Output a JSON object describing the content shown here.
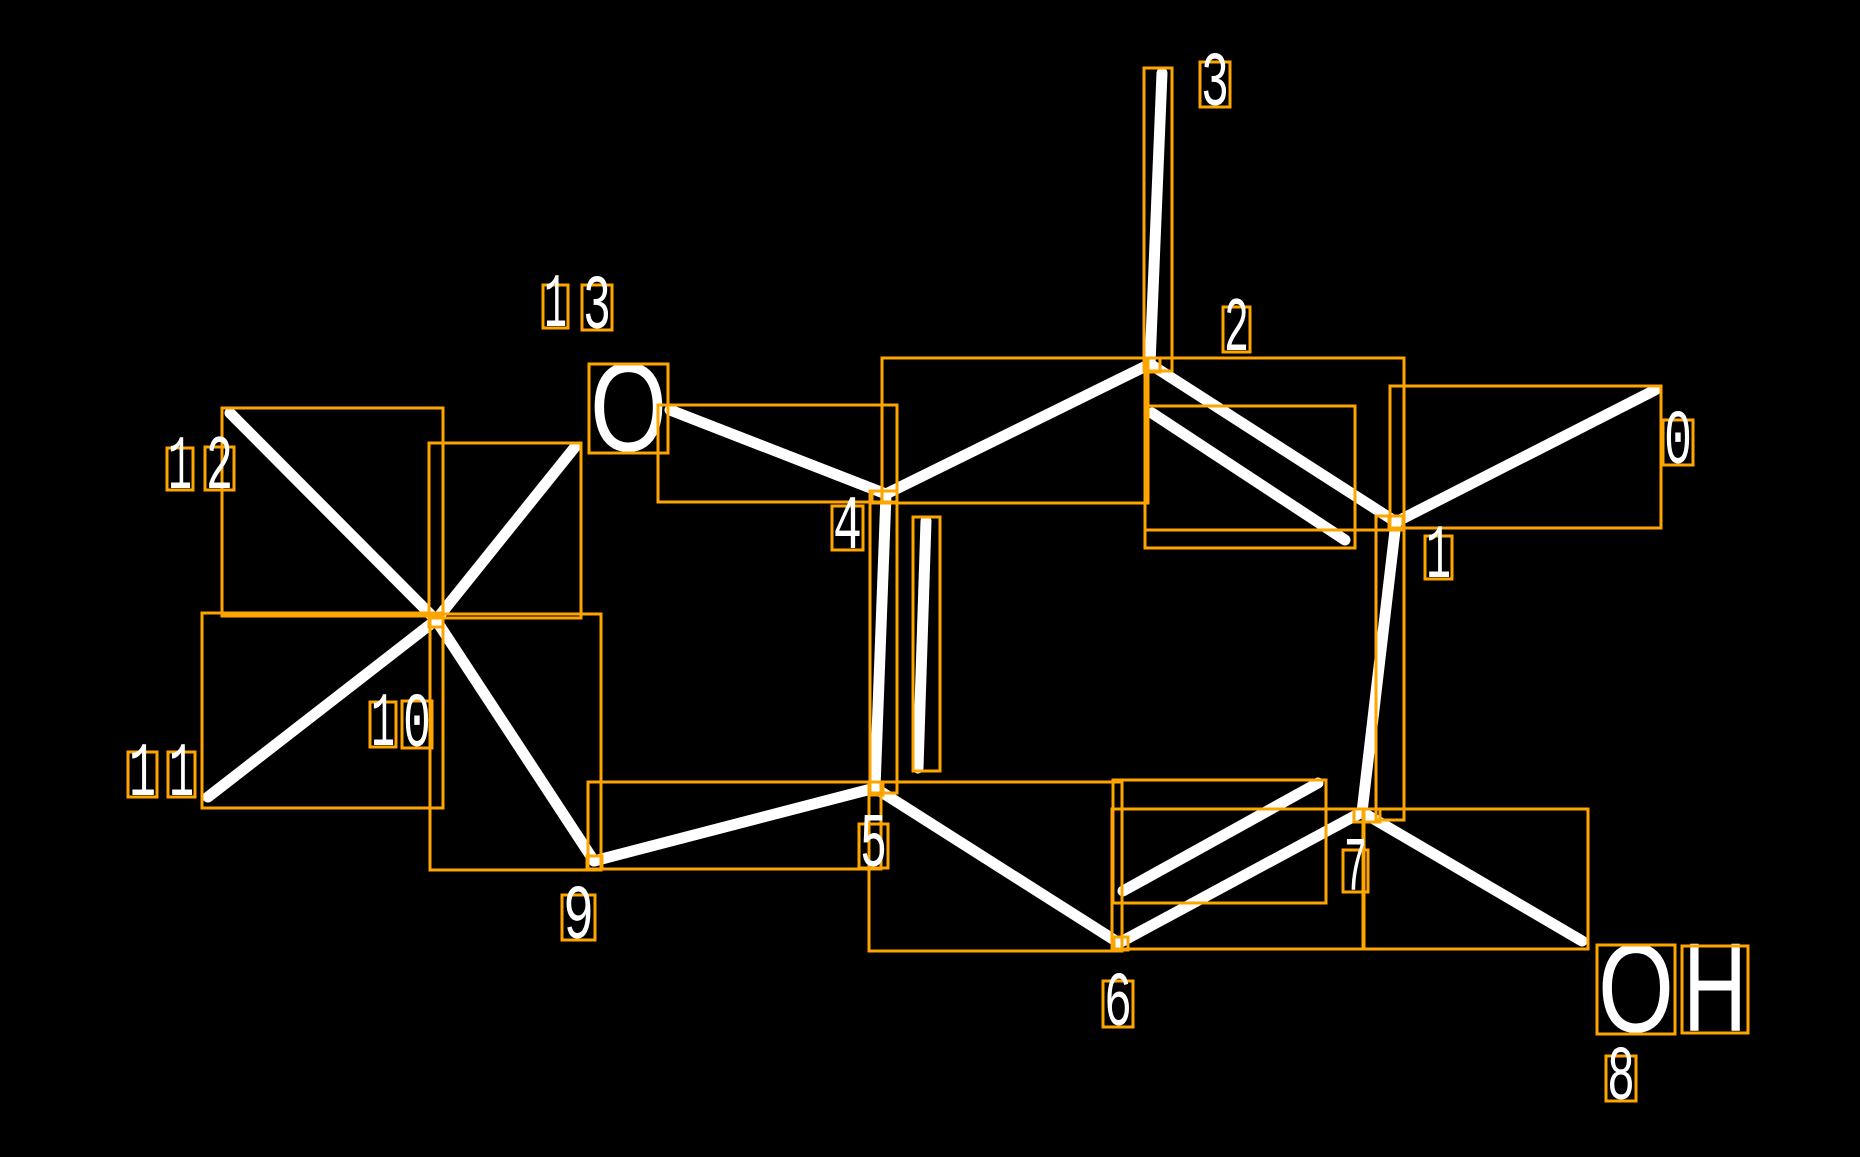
{
  "scene": {
    "width": 1860,
    "height": 1157,
    "style": {
      "background": "#000000",
      "bond_color": "#ffffff",
      "bond_width": 11,
      "box_color": "#ffa500",
      "box_stroke_width": 3,
      "label_color": "#ffffff",
      "digit_font_size": 77,
      "atom_font_size": 126
    },
    "bonds": [
      {
        "id": "0",
        "x1": 1396,
        "y1": 522,
        "x2": 1655,
        "y2": 390
      },
      {
        "id": "1",
        "x1": 1396,
        "y1": 522,
        "x2": 1362,
        "y2": 812
      },
      {
        "id": "2",
        "x1": 1150,
        "y1": 364,
        "x2": 1396,
        "y2": 522
      },
      {
        "id": "2-inner",
        "x1": 1152,
        "y1": 413,
        "x2": 1345,
        "y2": 540
      },
      {
        "id": "3",
        "x1": 1162,
        "y1": 73,
        "x2": 1150,
        "y2": 364
      },
      {
        "id": "ring-4-2",
        "x1": 886,
        "y1": 494,
        "x2": 1150,
        "y2": 364
      },
      {
        "id": "o-4",
        "x1": 670,
        "y1": 410,
        "x2": 886,
        "y2": 494
      },
      {
        "id": "13",
        "x1": 436,
        "y1": 620,
        "x2": 575,
        "y2": 447
      },
      {
        "id": "5",
        "x1": 886,
        "y1": 494,
        "x2": 875,
        "y2": 788
      },
      {
        "id": "5-inner",
        "x1": 926,
        "y1": 521,
        "x2": 918,
        "y2": 768
      },
      {
        "id": "6",
        "x1": 875,
        "y1": 788,
        "x2": 1119,
        "y2": 943
      },
      {
        "id": "7",
        "x1": 1119,
        "y1": 943,
        "x2": 1362,
        "y2": 812
      },
      {
        "id": "7-inner",
        "x1": 1123,
        "y1": 891,
        "x2": 1318,
        "y2": 783
      },
      {
        "id": "8",
        "x1": 1362,
        "y1": 812,
        "x2": 1582,
        "y2": 941
      },
      {
        "id": "9",
        "x1": 594,
        "y1": 861,
        "x2": 875,
        "y2": 788
      },
      {
        "id": "10",
        "x1": 436,
        "y1": 620,
        "x2": 594,
        "y2": 861
      },
      {
        "id": "11",
        "x1": 436,
        "y1": 620,
        "x2": 208,
        "y2": 797
      },
      {
        "id": "12",
        "x1": 230,
        "y1": 413,
        "x2": 436,
        "y2": 620
      }
    ],
    "bond_boxes": [
      {
        "id": "0",
        "box": [
          1390,
          386,
          1661,
          528
        ]
      },
      {
        "id": "1",
        "box": [
          1376,
          516,
          1404,
          820
        ]
      },
      {
        "id": "2",
        "box": [
          1145,
          358,
          1404,
          530
        ]
      },
      {
        "id": "2-inner",
        "box": [
          1145,
          406,
          1355,
          548
        ]
      },
      {
        "id": "3",
        "box": [
          1144,
          68,
          1172,
          371
        ]
      },
      {
        "id": "ring-4-2",
        "box": [
          882,
          358,
          1148,
          503
        ]
      },
      {
        "id": "o-4",
        "box": [
          658,
          405,
          897,
          502
        ]
      },
      {
        "id": "13",
        "box": [
          429,
          443,
          581,
          618
        ]
      },
      {
        "id": "5",
        "box": [
          870,
          491,
          897,
          793
        ]
      },
      {
        "id": "5-inner",
        "box": [
          913,
          517,
          940,
          771
        ]
      },
      {
        "id": "6",
        "box": [
          869,
          782,
          1122,
          951
        ]
      },
      {
        "id": "7",
        "box": [
          1112,
          809,
          1364,
          949
        ]
      },
      {
        "id": "7-inner",
        "box": [
          1113,
          780,
          1326,
          903
        ]
      },
      {
        "id": "8",
        "box": [
          1363,
          809,
          1588,
          949
        ]
      },
      {
        "id": "9",
        "box": [
          588,
          782,
          881,
          869
        ]
      },
      {
        "id": "10",
        "box": [
          430,
          614,
          601,
          870
        ]
      },
      {
        "id": "11",
        "box": [
          202,
          613,
          443,
          808
        ]
      },
      {
        "id": "12",
        "box": [
          222,
          408,
          443,
          616
        ]
      }
    ],
    "atom_boxes": [
      {
        "id": "quaternary-c",
        "box": [
          429,
          613,
          443,
          627
        ]
      },
      {
        "id": "ch2",
        "box": [
          587,
          856,
          602,
          869
        ]
      },
      {
        "id": "c5",
        "box": [
          869,
          782,
          883,
          795
        ]
      },
      {
        "id": "c4",
        "box": [
          872,
          491,
          897,
          503
        ]
      },
      {
        "id": "c2",
        "box": [
          1145,
          358,
          1160,
          372
        ]
      },
      {
        "id": "c1",
        "box": [
          1389,
          516,
          1403,
          528
        ]
      },
      {
        "id": "c7",
        "box": [
          1354,
          809,
          1380,
          822
        ]
      },
      {
        "id": "c6",
        "box": [
          1114,
          937,
          1128,
          950
        ]
      }
    ],
    "atom_labels": [
      {
        "id": "ether-oxygen",
        "text": "O",
        "box": [
          589,
          364,
          668,
          453
        ]
      },
      {
        "id": "hydroxyl-o",
        "text": "O",
        "box": [
          1597,
          945,
          1675,
          1034
        ]
      },
      {
        "id": "hydroxyl-h",
        "text": "H",
        "box": [
          1682,
          946,
          1748,
          1033
        ]
      }
    ],
    "index_labels": [
      {
        "id": "0",
        "text": "0",
        "box": [
          1663,
          420,
          1693,
          465
        ]
      },
      {
        "id": "1",
        "text": "1",
        "box": [
          1425,
          536,
          1452,
          579
        ]
      },
      {
        "id": "2",
        "text": "2",
        "box": [
          1223,
          307,
          1250,
          352
        ]
      },
      {
        "id": "3",
        "text": "3",
        "box": [
          1200,
          62,
          1230,
          107
        ]
      },
      {
        "id": "4",
        "text": "4",
        "box": [
          832,
          506,
          863,
          550
        ]
      },
      {
        "id": "5",
        "text": "5",
        "box": [
          859,
          824,
          888,
          868
        ]
      },
      {
        "id": "6",
        "text": "6",
        "box": [
          1103,
          981,
          1133,
          1027
        ]
      },
      {
        "id": "7",
        "text": "7",
        "box": [
          1343,
          850,
          1368,
          892
        ]
      },
      {
        "id": "8",
        "text": "8",
        "box": [
          1606,
          1056,
          1636,
          1101
        ]
      },
      {
        "id": "9",
        "text": "9",
        "box": [
          562,
          895,
          595,
          940
        ]
      },
      {
        "id": "10-a",
        "text": "1",
        "box": [
          370,
          702,
          396,
          747
        ]
      },
      {
        "id": "10-b",
        "text": "0",
        "box": [
          402,
          701,
          432,
          748
        ]
      },
      {
        "id": "11-a",
        "text": "1",
        "box": [
          128,
          752,
          157,
          797
        ]
      },
      {
        "id": "11-b",
        "text": "1",
        "box": [
          168,
          752,
          195,
          797
        ]
      },
      {
        "id": "12-a",
        "text": "1",
        "box": [
          167,
          448,
          193,
          490
        ]
      },
      {
        "id": "12-b",
        "text": "2",
        "box": [
          205,
          447,
          234,
          490
        ]
      },
      {
        "id": "13-a",
        "text": "1",
        "box": [
          543,
          285,
          568,
          328
        ]
      },
      {
        "id": "13-b",
        "text": "3",
        "box": [
          582,
          285,
          612,
          330
        ]
      }
    ]
  }
}
